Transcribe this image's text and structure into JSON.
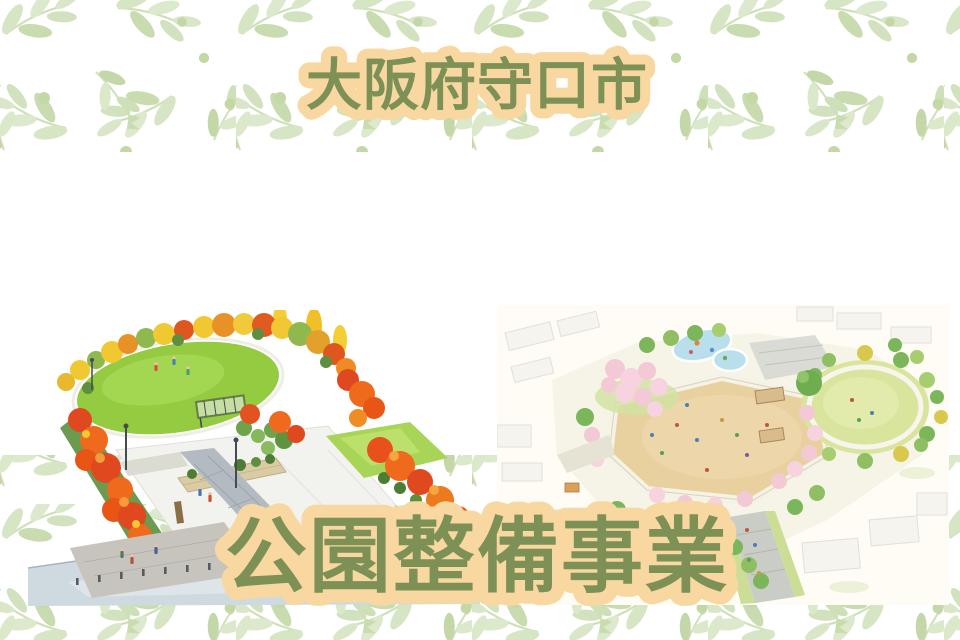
{
  "titles": {
    "top": "大阪府守口市",
    "bottom": "公園整備事業"
  },
  "theme": {
    "title_text_color": "#7d9156",
    "title_highlight_color": "#f8d8a0",
    "pattern_leaf_color": "#d6e4c4",
    "panel_background": "#ffffff",
    "left_art_accents": [
      "#e0481f",
      "#f08c22",
      "#f2c832",
      "#94cb40"
    ],
    "right_art_accents": [
      "#e9d09f",
      "#b9dfec",
      "#f3c9d6",
      "#d9e49c"
    ]
  }
}
